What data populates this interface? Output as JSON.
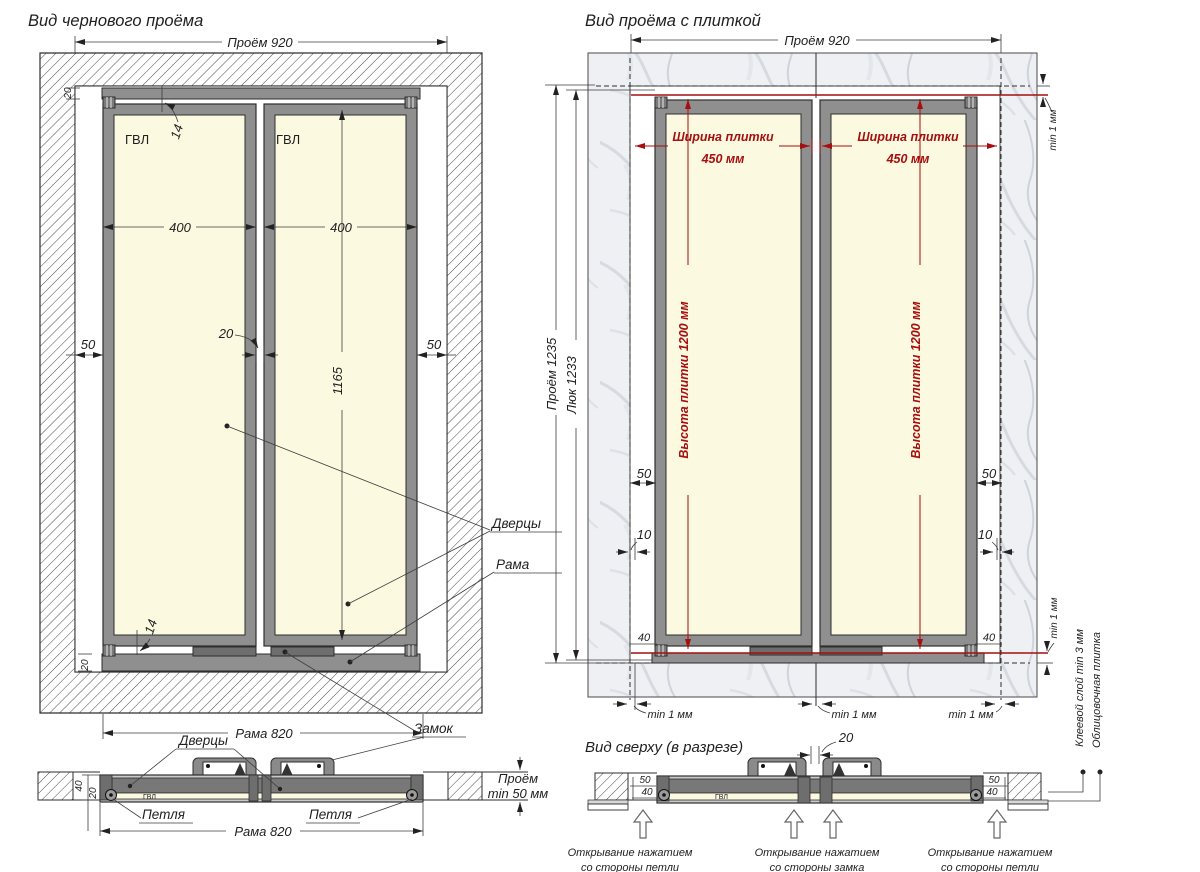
{
  "left_view": {
    "title": "Вид чернового проёма",
    "dim_opening_w": "Проём 920",
    "panel_material": "ГВЛ",
    "dim_door_w": "400",
    "dim_side_gap": "50",
    "dim_rail": "20",
    "dim_gap14": "14",
    "dim_center_gap": "20",
    "dim_door_h": "1165",
    "dim_frame_w": "Рама 820",
    "label_doors": "Дверцы",
    "label_frame": "Рама",
    "label_lock": "Замок",
    "label_hinge": "Петля",
    "dim_depth_line1": "Проём",
    "dim_depth_line2": "min 50 мм",
    "dim_40": "40",
    "dim_20": "20",
    "section_material": "ГВЛ"
  },
  "right_view": {
    "title": "Вид проёма с плиткой",
    "dim_opening_w": "Проём 920",
    "dim_opening_h": "Проём 1235",
    "dim_hatch_h": "Люк 1233",
    "tile_width_line1": "Ширина плитки",
    "tile_width_line2": "450 мм",
    "tile_height": "Высота плитки 1200 мм",
    "dim_50": "50",
    "dim_10": "10",
    "dim_40": "40",
    "dim_min1": "min 1 мм",
    "label_glue": "Клеевой слой min 3 мм",
    "label_tile": "Облицовочная плитка"
  },
  "section_view": {
    "title": "Вид сверху (в разрезе)",
    "dim_center_gap": "20",
    "dim_50": "50",
    "dim_40": "40",
    "open_line1": "Открывание нажатием",
    "open_hinge_line2": "со стороны петли",
    "open_lock_line2": "со стороны замка"
  },
  "colors": {
    "accent_red": "#a50f0f",
    "panel_fill": "#fcf9e1",
    "frame_gray": "#8f8f8f",
    "line_dark": "#2e2e2e"
  }
}
